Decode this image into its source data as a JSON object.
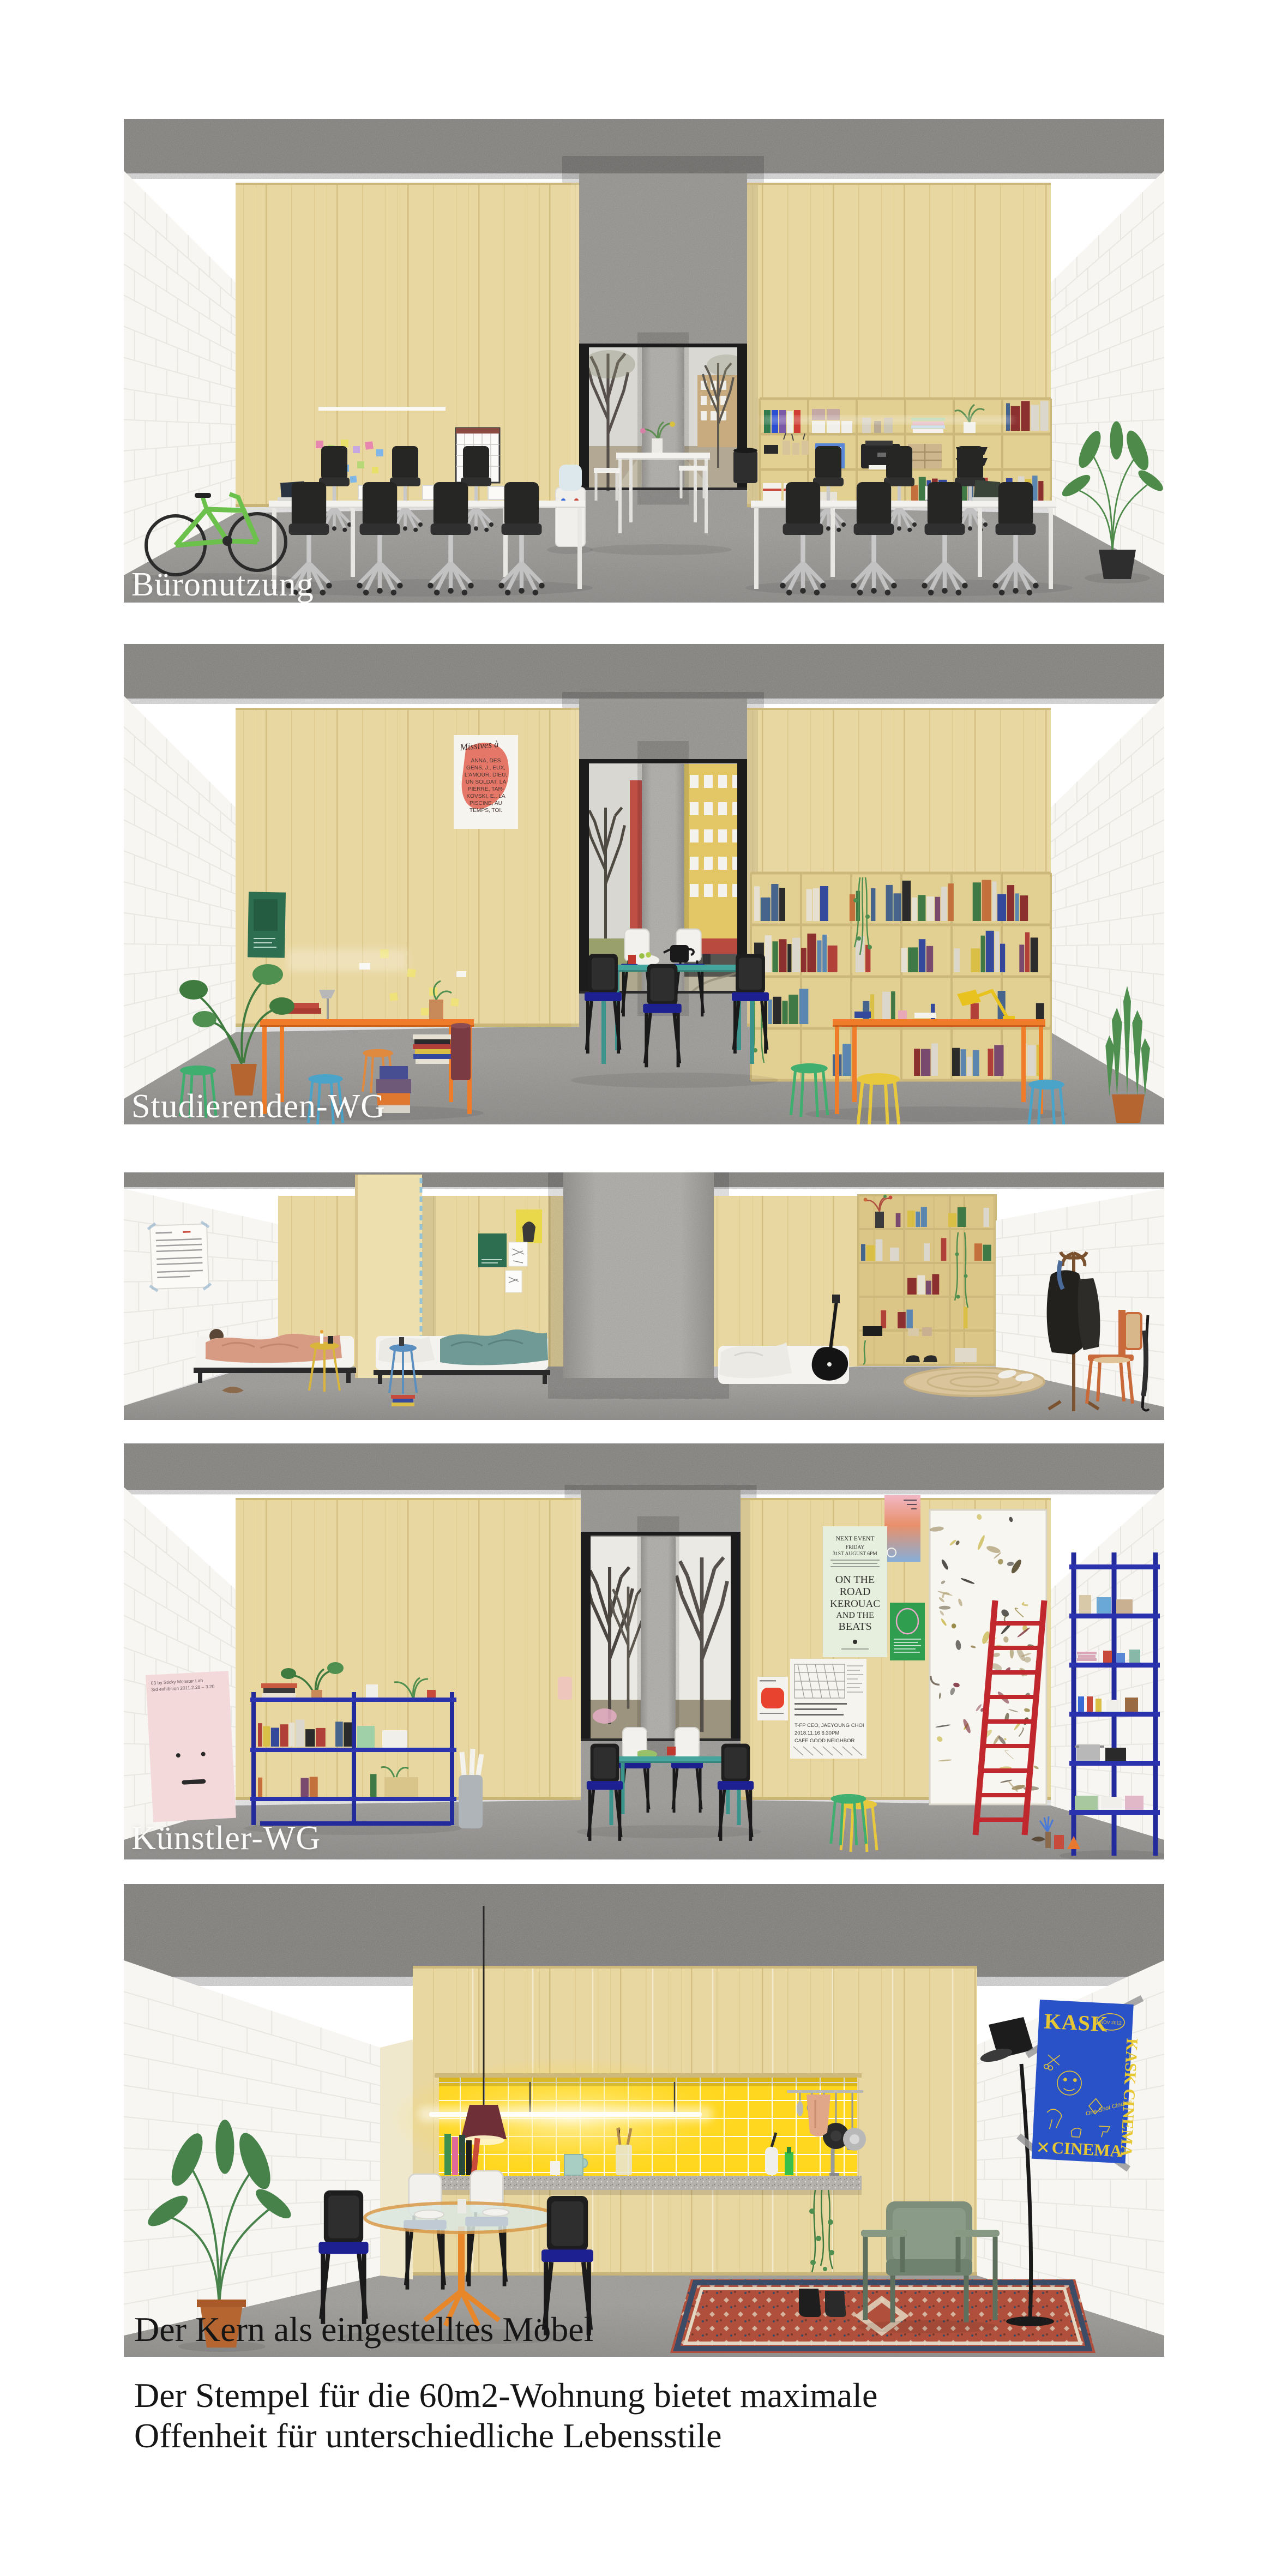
{
  "page": {
    "background": "#ffffff"
  },
  "palette": {
    "wood": "#e9d7a1",
    "wood_dark": "#d9c589",
    "ceiling": "#a8a6a3",
    "floor": "#b6b4b1",
    "brick": "#f7f6f2",
    "accent_orange": "#ee7c28",
    "accent_teal": "#45a49b",
    "shelf_navy": "#232a9b",
    "seat_navy": "#1c2090",
    "ladder_red": "#c0282d",
    "tile_yellow": "#ffd71f",
    "poster_blue": "#2a52c8",
    "poster_yellow": "#e8c832",
    "armchair_green": "#7d8f7b",
    "rug_red": "#b0503c",
    "bike_green": "#6cc04c"
  },
  "panels": [
    {
      "id": "bueronutzung",
      "label": "Büronutzung"
    },
    {
      "id": "studierenden-wg",
      "label": "Studierenden-WG"
    },
    {
      "id": "schlafkabinen",
      "label": ""
    },
    {
      "id": "kuenstler-wg",
      "label": "Künstler-WG"
    },
    {
      "id": "kern-wohnung",
      "label": ""
    }
  ],
  "caption": {
    "title": "Der Kern als eingestelltes Möbel",
    "line1": "Der Stempel für die 60m2-Wohnung bietet maximale",
    "line2": "Offenheit für unterschiedliche Lebensstile"
  },
  "posters": {
    "missives": {
      "heading": "Missives à",
      "lines": [
        "ANNA, DES",
        "GENS, J., EUX,",
        "L'AMOUR, DIEU,",
        "UN SOLDAT, LA",
        "PIERRE, TAR-",
        "KOVSKI, E., LA",
        "PISCINE, AU",
        "TEMPS, TOI."
      ]
    },
    "next_event": {
      "lines": [
        "NEXT EVENT",
        "FRIDAY",
        "31ST AUGUST 6PM",
        "ON THE",
        "ROAD",
        "KEROUAC",
        "AND THE",
        "BEATS"
      ]
    },
    "schedule": {
      "lines": [
        "T-FP CEO, JAEYOUNG CHOI",
        "2018.11.16 6:30PM",
        "CAFE GOOD NEIGHBOR"
      ]
    },
    "kask": {
      "title": "KASK",
      "vertical": "KASK CINEMA",
      "tagline": "One Shot Cinema",
      "bottom": "CINEMA",
      "date": "NOV 2012"
    },
    "sticky_monster": {
      "line1": "03 by Sticky Monster Lab",
      "line2": "3rd exhibition 2011.2.28 – 3.20"
    }
  }
}
